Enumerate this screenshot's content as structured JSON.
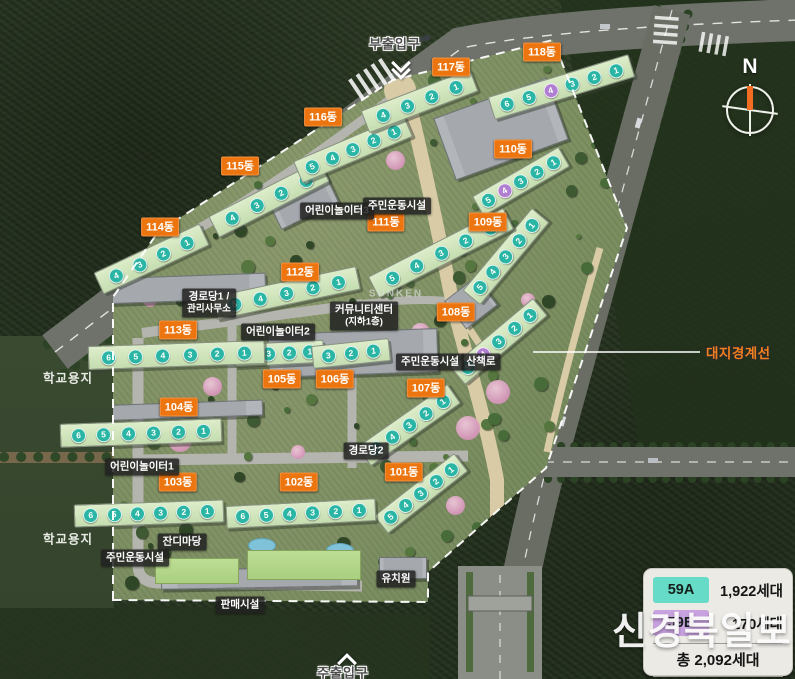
{
  "entrances": {
    "sub": "부출입구",
    "main": "주출입구"
  },
  "boundary_label": "대지경계선",
  "north_label": "N",
  "school_site_label": "학교용지",
  "watermark": "신경북일보",
  "legend": {
    "items": [
      {
        "code": "59A",
        "color": "#66dbc7",
        "households": "1,922세대"
      },
      {
        "code": "59B",
        "color": "#c9a3e0",
        "households": "170세대"
      }
    ],
    "total": "총 2,092세대"
  },
  "unit_colors": {
    "A": "#2ab5a4",
    "B": "#b07fd2"
  },
  "buildings": [
    {
      "name": "101동",
      "x": 404,
      "y": 472,
      "bar": {
        "x": 420,
        "y": 492,
        "w": 100,
        "h": 21,
        "r": -38
      },
      "units": [
        5,
        4,
        3,
        2,
        1
      ],
      "purple": []
    },
    {
      "name": "102동",
      "x": 299,
      "y": 482,
      "bar": {
        "x": 300,
        "y": 512,
        "w": 148,
        "h": 21,
        "r": -3
      },
      "units": [
        6,
        5,
        4,
        3,
        2,
        1
      ],
      "purple": []
    },
    {
      "name": "103동",
      "x": 178,
      "y": 482,
      "bar": {
        "x": 148,
        "y": 512,
        "w": 148,
        "h": 21,
        "r": -2
      },
      "units": [
        6,
        5,
        4,
        3,
        2,
        1
      ],
      "purple": []
    },
    {
      "name": "104동",
      "x": 179,
      "y": 407,
      "bar": {
        "x": 140,
        "y": 432,
        "w": 160,
        "h": 22,
        "r": -2
      },
      "units": [
        6,
        5,
        4,
        3,
        2,
        1
      ],
      "purple": []
    },
    {
      "name": "105동",
      "x": 282,
      "y": 379,
      "bar": {
        "x": 278,
        "y": 352,
        "w": 88,
        "h": 21,
        "r": -3
      },
      "units": [
        4,
        3,
        2,
        1
      ],
      "purple": []
    },
    {
      "name": "106동",
      "x": 335,
      "y": 379,
      "bar": {
        "x": 350,
        "y": 352,
        "w": 76,
        "h": 21,
        "r": -6
      },
      "units": [
        3,
        2,
        1
      ],
      "purple": []
    },
    {
      "name": "107동",
      "x": 426,
      "y": 388,
      "bar": {
        "x": 408,
        "y": 424,
        "w": 108,
        "h": 22,
        "r": -35
      },
      "units": [
        5,
        4,
        3,
        2,
        1
      ],
      "purple": []
    },
    {
      "name": "108동",
      "x": 456,
      "y": 312,
      "bar": {
        "x": 498,
        "y": 340,
        "w": 106,
        "h": 21,
        "r": -40
      },
      "units": [
        5,
        4,
        3,
        2,
        1
      ],
      "purple": [
        4
      ]
    },
    {
      "name": "109동",
      "x": 488,
      "y": 222,
      "bar": {
        "x": 505,
        "y": 255,
        "w": 106,
        "h": 21,
        "r": -50
      },
      "units": [
        5,
        4,
        3,
        2,
        1
      ],
      "purple": []
    },
    {
      "name": "110동",
      "x": 513,
      "y": 149,
      "bar": {
        "x": 520,
        "y": 180,
        "w": 98,
        "h": 21,
        "r": -30
      },
      "units": [
        5,
        4,
        3,
        2,
        1
      ],
      "purple": [
        4
      ]
    },
    {
      "name": "111동",
      "x": 386,
      "y": 222,
      "bar": {
        "x": 440,
        "y": 252,
        "w": 150,
        "h": 22,
        "r": -27
      },
      "units": [
        5,
        4,
        3,
        2,
        1
      ],
      "purple": []
    },
    {
      "name": "112동",
      "x": 300,
      "y": 272,
      "bar": {
        "x": 285,
        "y": 292,
        "w": 145,
        "h": 22,
        "r": -12
      },
      "units": [
        5,
        4,
        3,
        2,
        1
      ],
      "purple": []
    },
    {
      "name": "113동",
      "x": 178,
      "y": 330,
      "bar": {
        "x": 175,
        "y": 354,
        "w": 175,
        "h": 22,
        "r": -2
      },
      "units": [
        6,
        5,
        4,
        3,
        2,
        1
      ],
      "purple": []
    },
    {
      "name": "114동",
      "x": 160,
      "y": 227,
      "bar": {
        "x": 150,
        "y": 258,
        "w": 115,
        "h": 22,
        "r": -25
      },
      "units": [
        4,
        3,
        2,
        1
      ],
      "purple": []
    },
    {
      "name": "115동",
      "x": 240,
      "y": 166,
      "bar": {
        "x": 268,
        "y": 198,
        "w": 122,
        "h": 22,
        "r": -27
      },
      "units": [
        4,
        3,
        2,
        1
      ],
      "purple": []
    },
    {
      "name": "116동",
      "x": 323,
      "y": 117,
      "bar": {
        "x": 352,
        "y": 148,
        "w": 118,
        "h": 22,
        "r": -23
      },
      "units": [
        5,
        4,
        3,
        2,
        1
      ],
      "purple": []
    },
    {
      "name": "117동",
      "x": 451,
      "y": 67,
      "bar": {
        "x": 418,
        "y": 100,
        "w": 115,
        "h": 22,
        "r": -21
      },
      "units": [
        4,
        3,
        2,
        1
      ],
      "purple": []
    },
    {
      "name": "118동",
      "x": 542,
      "y": 52,
      "bar": {
        "x": 560,
        "y": 86,
        "w": 145,
        "h": 22,
        "r": -17
      },
      "units": [
        6,
        5,
        4,
        3,
        2,
        1
      ],
      "purple": [
        4
      ]
    }
  ],
  "facilities": [
    {
      "text": "어린이놀이터3",
      "x": 337,
      "y": 211
    },
    {
      "text": "주민운동시설",
      "x": 397,
      "y": 206
    },
    {
      "text": "커뮤니티센터",
      "sub": "(지하1층)",
      "x": 364,
      "y": 316
    },
    {
      "text": "경로당1 /",
      "sub": "관리사무소",
      "x": 209,
      "y": 303
    },
    {
      "text": "어린이놀이터2",
      "x": 278,
      "y": 332
    },
    {
      "text": "주민운동시설",
      "x": 430,
      "y": 362
    },
    {
      "text": "산책로",
      "x": 481,
      "y": 362
    },
    {
      "text": "경로당2",
      "x": 366,
      "y": 451
    },
    {
      "text": "어린이놀이터1",
      "x": 142,
      "y": 467
    },
    {
      "text": "잔디마당",
      "x": 182,
      "y": 542
    },
    {
      "text": "주민운동시설",
      "x": 135,
      "y": 558
    },
    {
      "text": "판매시설",
      "x": 240,
      "y": 605
    },
    {
      "text": "유치원",
      "x": 396,
      "y": 579
    },
    {
      "text": "SUNKEN",
      "x": 396,
      "y": 294,
      "style": "ghost"
    }
  ],
  "school_sites": [
    {
      "x": 68,
      "y": 377
    },
    {
      "x": 68,
      "y": 538
    }
  ]
}
